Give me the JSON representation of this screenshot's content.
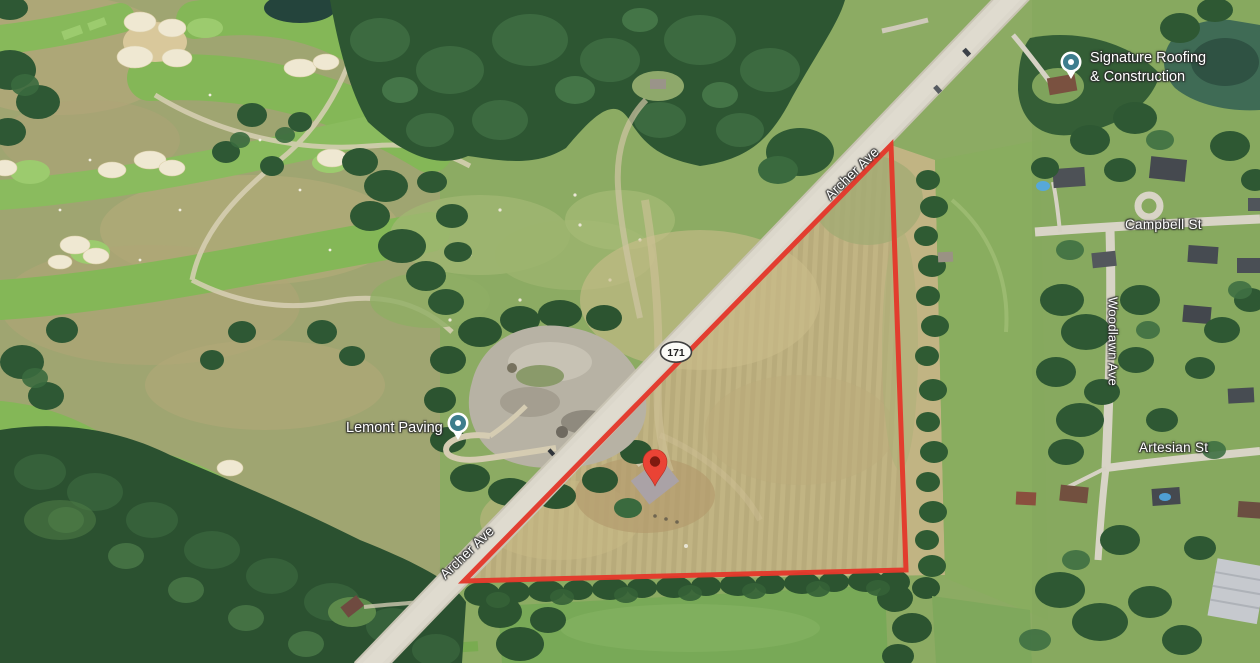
{
  "map": {
    "view": "satellite",
    "streets": {
      "archer_upper": "Archer Ave",
      "archer_lower": "Archer Ave",
      "campbell": "Campbell St",
      "woodlawn": "Woodlawn Ave",
      "artesian": "Artesian St"
    },
    "route_shield": {
      "number": "171"
    },
    "pois": {
      "signature": {
        "line1": "Signature Roofing",
        "line2": "& Construction"
      },
      "lemont": {
        "label": "Lemont Paving"
      }
    },
    "icons": {
      "property_pin": "red-map-pin",
      "business_marker": "teal-circle-pin",
      "route_shield": "oval-route-shield"
    },
    "colors": {
      "boundary_red": "#e3392b",
      "pin_red": "#ea4335",
      "pin_inner": "#7f1a10",
      "poi_teal": "#3e7d8d",
      "road": "#dbd7cb",
      "field_tan": "#c1b483",
      "fairway_green": "#8cbd60",
      "forest_green": "#2d5531",
      "water_green": "#3f6b55"
    }
  }
}
